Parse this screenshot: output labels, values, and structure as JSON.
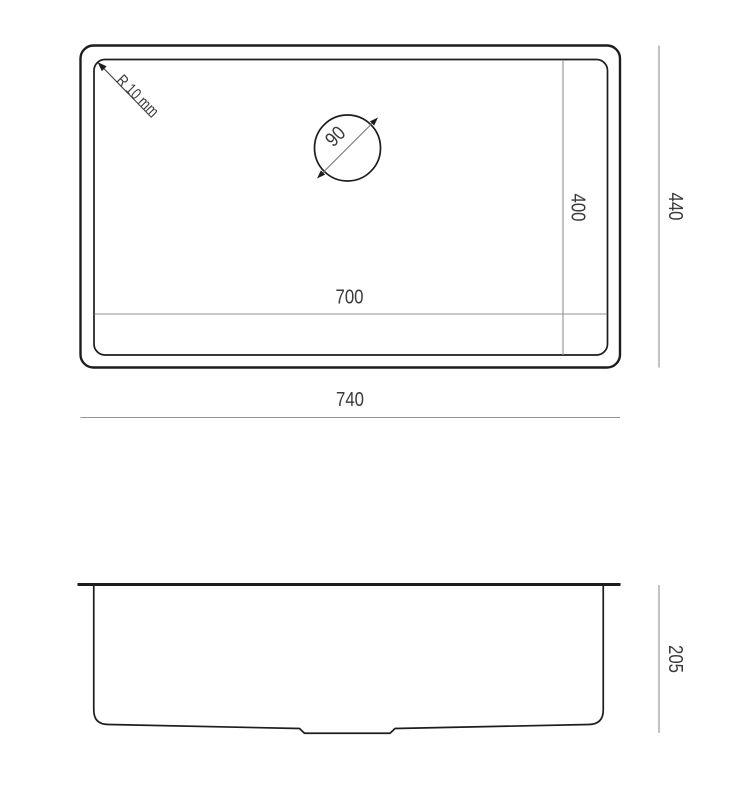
{
  "drawing": {
    "top_view": {
      "overall_width_label": "740",
      "overall_depth_label": "440",
      "bowl_width_label": "700",
      "bowl_depth_label": "400",
      "drain_diameter_label": "90",
      "corner_radius_label": "R 10 mm"
    },
    "side_view": {
      "overall_height_label": "205"
    },
    "colors": {
      "outline": "#1d1d1b",
      "dimension_line": "#929292",
      "leader_line": "#4a4a4a",
      "text": "#3a3a3a",
      "background": "#ffffff"
    }
  }
}
